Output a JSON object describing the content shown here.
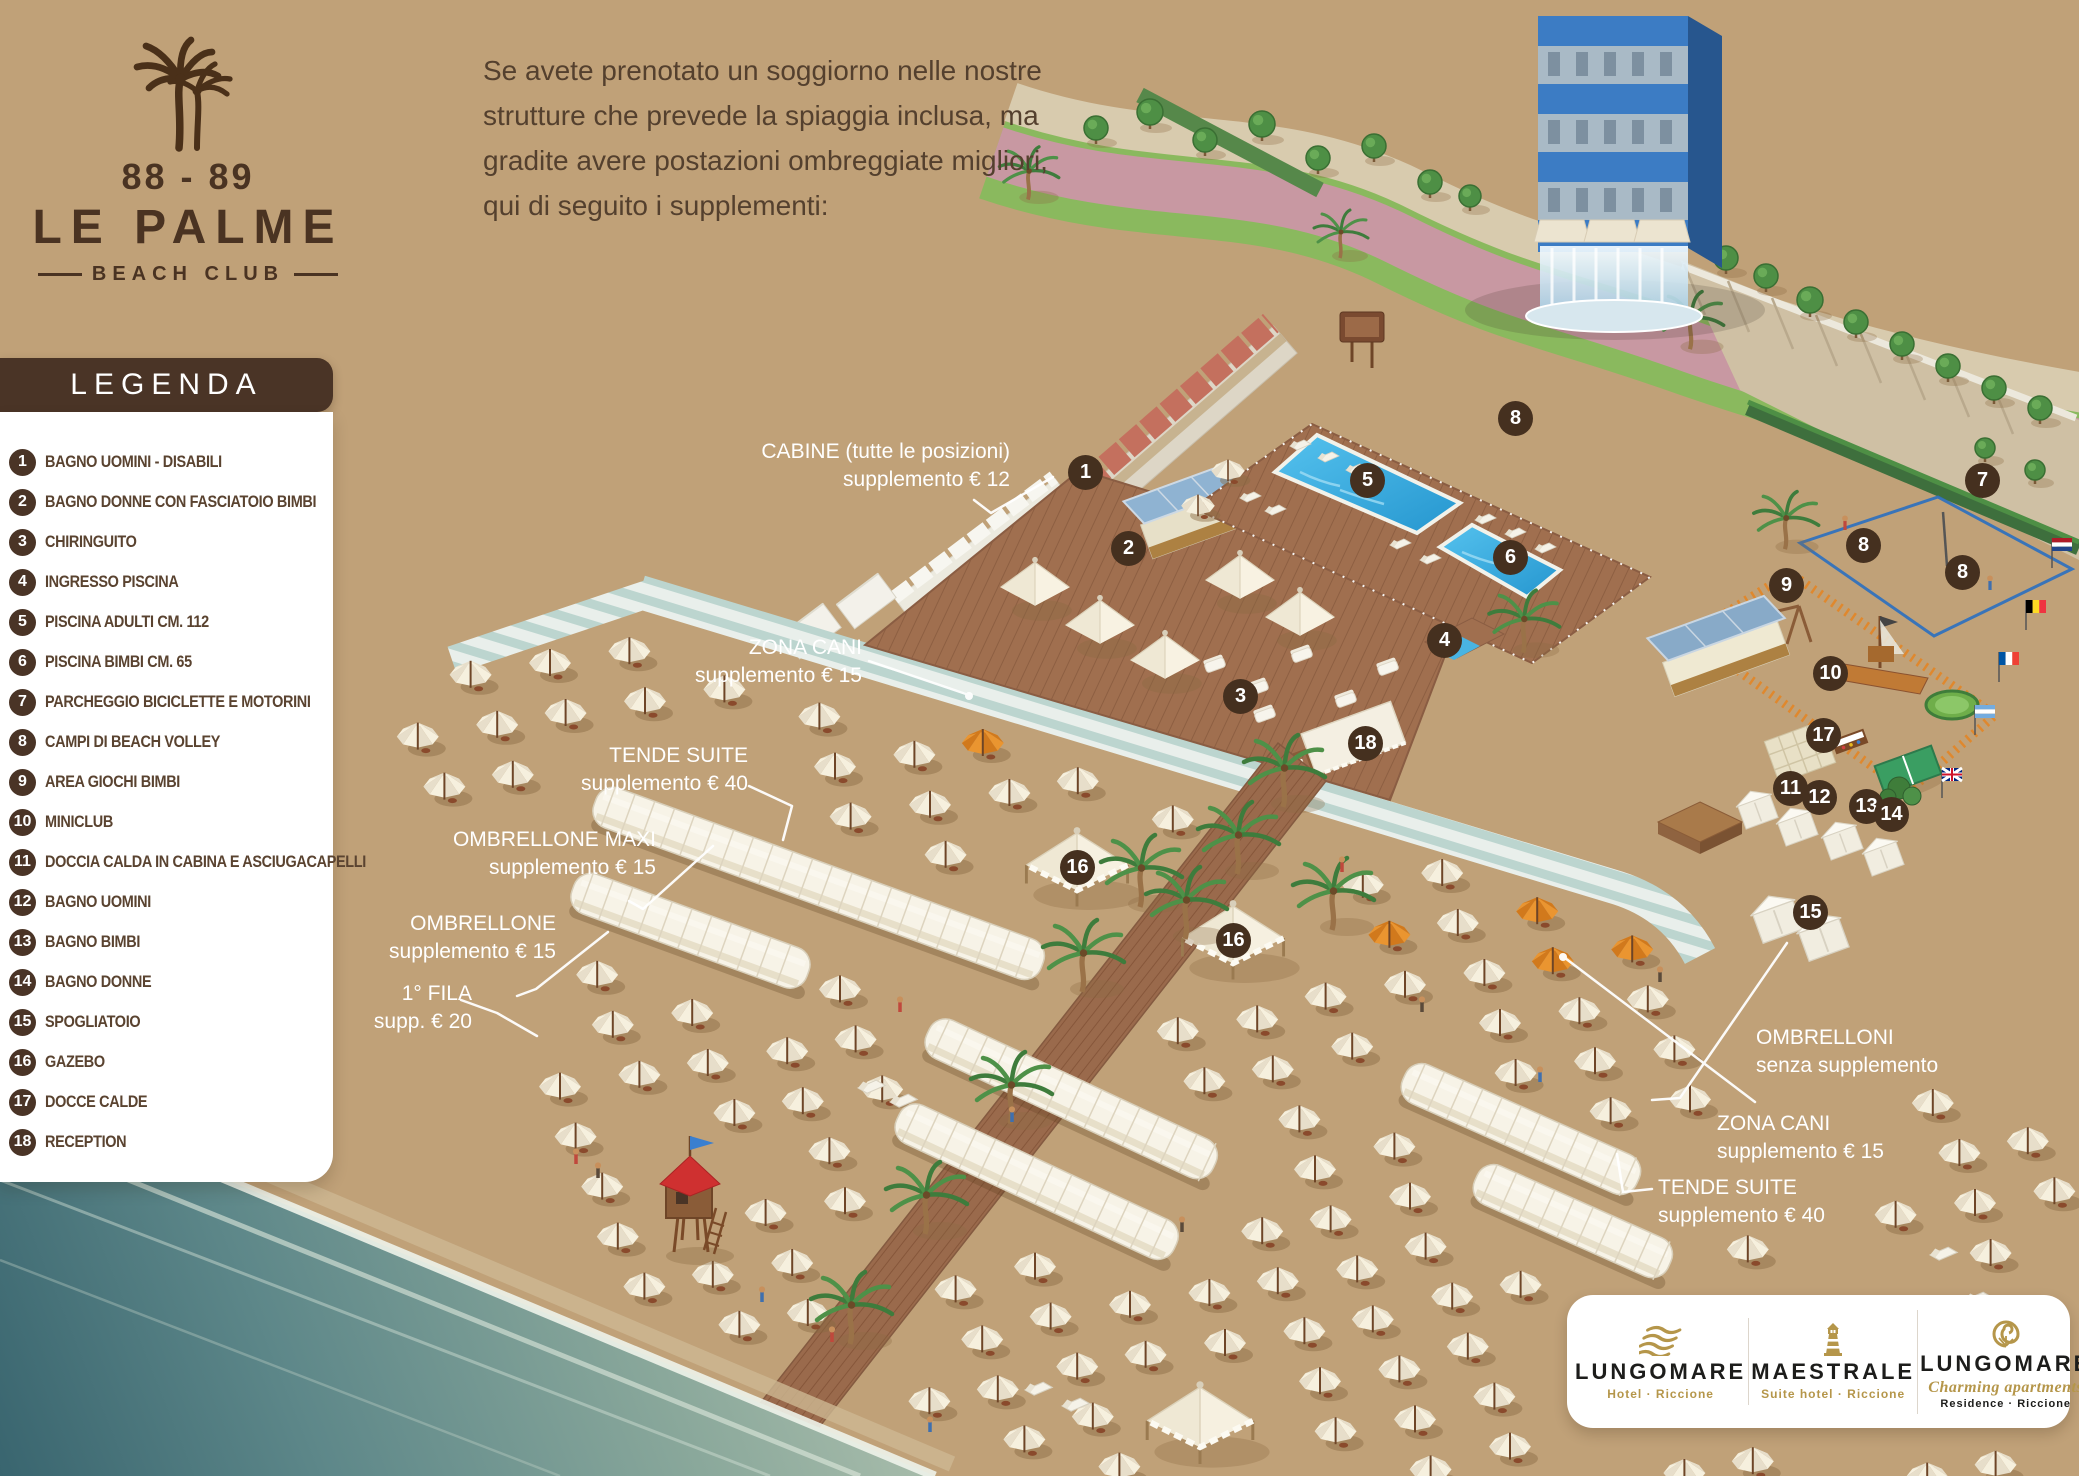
{
  "logo": {
    "numbers": "88 - 89",
    "name": "LE PALME",
    "subtitle": "BEACH CLUB"
  },
  "intro": {
    "text": "Se avete prenotato un soggiorno nelle nostre\nstrutture che prevede la spiaggia inclusa, ma\ngradite avere postazioni ombreggiate migliori,\nqui di seguito i supplementi:"
  },
  "legend": {
    "title": "LEGENDA",
    "items": [
      {
        "num": "1",
        "label": "BAGNO UOMINI - DISABILI"
      },
      {
        "num": "2",
        "label": "BAGNO DONNE CON FASCIATOIO BIMBI"
      },
      {
        "num": "3",
        "label": "CHIRINGUITO"
      },
      {
        "num": "4",
        "label": "INGRESSO PISCINA"
      },
      {
        "num": "5",
        "label": "PISCINA ADULTI CM. 112"
      },
      {
        "num": "6",
        "label": "PISCINA BIMBI CM. 65"
      },
      {
        "num": "7",
        "label": "PARCHEGGIO BICICLETTE E MOTORINI"
      },
      {
        "num": "8",
        "label": "CAMPI DI BEACH VOLLEY"
      },
      {
        "num": "9",
        "label": "AREA GIOCHI BIMBI"
      },
      {
        "num": "10",
        "label": "MINICLUB"
      },
      {
        "num": "11",
        "label": "DOCCIA CALDA IN CABINA E ASCIUGACAPELLI"
      },
      {
        "num": "12",
        "label": "BAGNO UOMINI"
      },
      {
        "num": "13",
        "label": "BAGNO BIMBI"
      },
      {
        "num": "14",
        "label": "BAGNO DONNE"
      },
      {
        "num": "15",
        "label": "SPOGLIATOIO"
      },
      {
        "num": "16",
        "label": "GAZEBO"
      },
      {
        "num": "17",
        "label": "DOCCE CALDE"
      },
      {
        "num": "18",
        "label": "RECEPTION"
      }
    ]
  },
  "map_labels": {
    "cabine": {
      "l1": "CABINE (tutte le posizioni)",
      "l2": "supplemento € 12"
    },
    "zona_cani_left": {
      "l1": "ZONA CANI",
      "l2": "supplemento € 15"
    },
    "tende_suite_left": {
      "l1": "TENDE SUITE",
      "l2": "supplemento € 40"
    },
    "ombrellone_maxi": {
      "l1": "OMBRELLONE MAXI",
      "l2": "supplemento € 15"
    },
    "ombrellone": {
      "l1": "OMBRELLONE",
      "l2": "supplemento € 15"
    },
    "prima_fila": {
      "l1": "1° FILA",
      "l2": "supp. € 20"
    },
    "ombrelloni": {
      "l1": "OMBRELLONI",
      "l2": "senza supplemento"
    },
    "zona_cani_right": {
      "l1": "ZONA CANI",
      "l2": "supplemento € 15"
    },
    "tende_suite_right": {
      "l1": "TENDE SUITE",
      "l2": "supplemento € 40"
    }
  },
  "markers": [
    {
      "num": "1",
      "x": 1085,
      "y": 472
    },
    {
      "num": "2",
      "x": 1128,
      "y": 548
    },
    {
      "num": "3",
      "x": 1240,
      "y": 696
    },
    {
      "num": "4",
      "x": 1444,
      "y": 640
    },
    {
      "num": "5",
      "x": 1367,
      "y": 480
    },
    {
      "num": "6",
      "x": 1510,
      "y": 557
    },
    {
      "num": "7",
      "x": 1982,
      "y": 480
    },
    {
      "num": "8",
      "x": 1515,
      "y": 418
    },
    {
      "num": "8",
      "x": 1863,
      "y": 545
    },
    {
      "num": "8",
      "x": 1962,
      "y": 572
    },
    {
      "num": "9",
      "x": 1786,
      "y": 585
    },
    {
      "num": "10",
      "x": 1830,
      "y": 673
    },
    {
      "num": "11",
      "x": 1790,
      "y": 788
    },
    {
      "num": "12",
      "x": 1819,
      "y": 797
    },
    {
      "num": "13",
      "x": 1866,
      "y": 806
    },
    {
      "num": "14",
      "x": 1891,
      "y": 814
    },
    {
      "num": "15",
      "x": 1810,
      "y": 912
    },
    {
      "num": "16",
      "x": 1077,
      "y": 867
    },
    {
      "num": "16",
      "x": 1233,
      "y": 940
    },
    {
      "num": "17",
      "x": 1823,
      "y": 735
    },
    {
      "num": "18",
      "x": 1365,
      "y": 743
    }
  ],
  "footer": {
    "hotels": [
      {
        "name": "LUNGOMARE",
        "tagline": "Hotel · Riccione",
        "icon": "waves-icon"
      },
      {
        "name": "MAESTRALE",
        "tagline": "Suite hotel · Riccione",
        "icon": "lighthouse-icon"
      },
      {
        "name": "LUNGOMARE",
        "tagline": "Charming apartments",
        "tagline2": "Residence · Riccione",
        "icon": "shell-icon"
      }
    ]
  },
  "colors": {
    "sand": "#c0a178",
    "sea_deep": "#39656f",
    "dark_brown": "#4a3426",
    "legend_text": "#5a4330",
    "pool_blue": "#3fb0e4",
    "orange_umbrella": "#e8912a",
    "accent_gold": "#b5964a",
    "label_white": "#ffffff"
  }
}
